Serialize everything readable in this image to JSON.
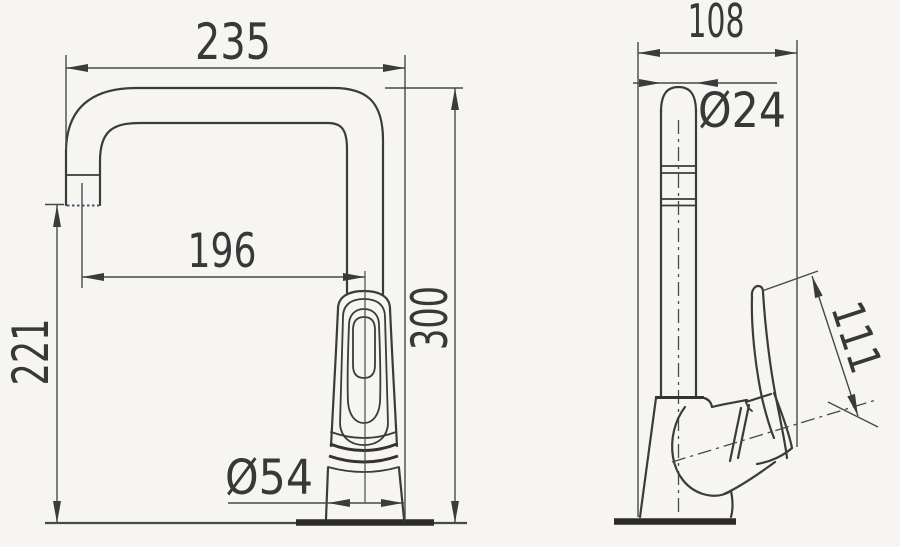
{
  "drawing": {
    "type": "technical-dimension-drawing",
    "subject": "single-lever kitchen faucet, front and side orthographic views",
    "colors": {
      "background": "#f6f5f2",
      "line": "#3b3b3b",
      "dim_line": "#45484c",
      "deck": "#2c2b27",
      "text": "#383838"
    },
    "dimensions": {
      "front": {
        "spout_width": "235",
        "spout_reach": "196",
        "spout_outlet_height": "221",
        "total_height": "300",
        "base_diameter": "Ø54"
      },
      "side": {
        "depth": "108",
        "spout_tube_diameter": "Ø24",
        "handle_length": "111"
      }
    }
  }
}
